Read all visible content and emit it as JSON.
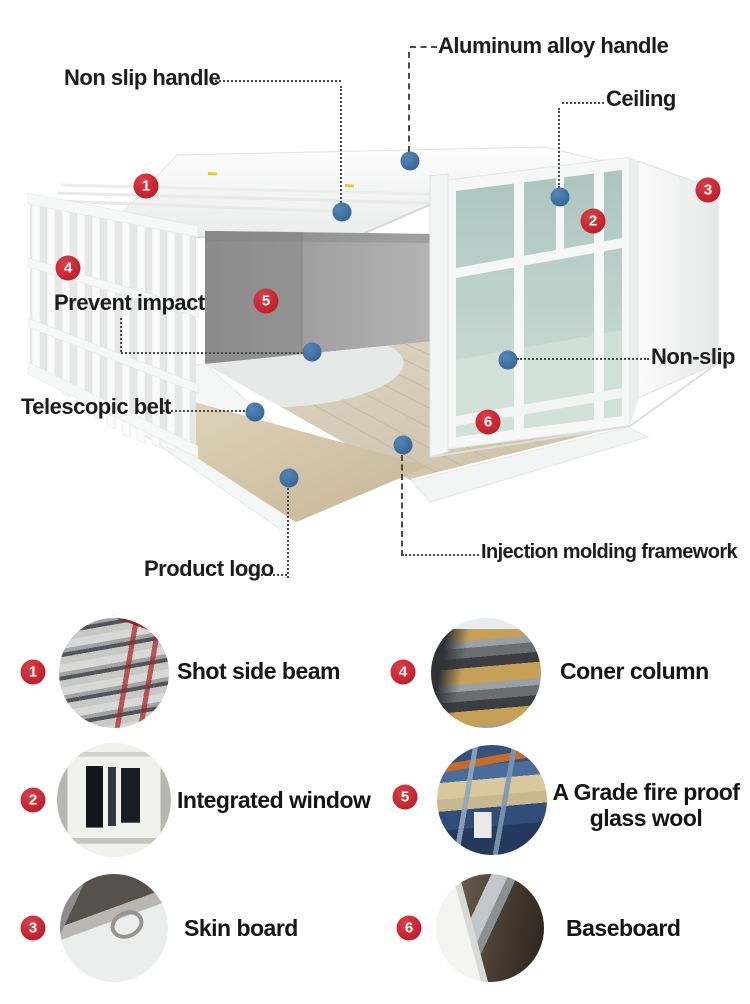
{
  "colors": {
    "badge_red": "#c3232e",
    "dot_blue": "#3e6d9f",
    "glass_green": "#b5cbc5",
    "floor_wood": "#d7cdba",
    "label_text": "#1d1d1d"
  },
  "diagram": {
    "callouts": [
      {
        "id": "aluminum-alloy-handle",
        "label": "Aluminum alloy handle"
      },
      {
        "id": "non-slip-handle",
        "label": "Non slip handle"
      },
      {
        "id": "ceiling",
        "label": "Ceiling"
      },
      {
        "id": "prevent-impact",
        "label": "Prevent impact"
      },
      {
        "id": "non-slip",
        "label": "Non-slip"
      },
      {
        "id": "telescopic-belt",
        "label": "Telescopic belt"
      },
      {
        "id": "product-logo",
        "label": "Product logo"
      },
      {
        "id": "injection-molding-framework",
        "label": "Injection molding framework"
      }
    ],
    "markers": [
      "1",
      "2",
      "3",
      "4",
      "5",
      "6"
    ]
  },
  "legend": {
    "items": [
      {
        "number": "1",
        "label": "Shot side beam",
        "photo": "stacked-steel-side-beams"
      },
      {
        "number": "4",
        "label": "Coner column",
        "photo": "corner-column-sandwich-panels"
      },
      {
        "number": "2",
        "label": "Integrated window",
        "photo": "white-framed-window"
      },
      {
        "number": "5",
        "label_lines": [
          "A Grade fire proof",
          "glass wool"
        ],
        "photo": "glass-wool-production-line"
      },
      {
        "number": "3",
        "label": "Skin board",
        "photo": "metal-skin-board-corner"
      },
      {
        "number": "6",
        "label": "Baseboard",
        "photo": "baseboard-corner-bracket"
      }
    ]
  }
}
